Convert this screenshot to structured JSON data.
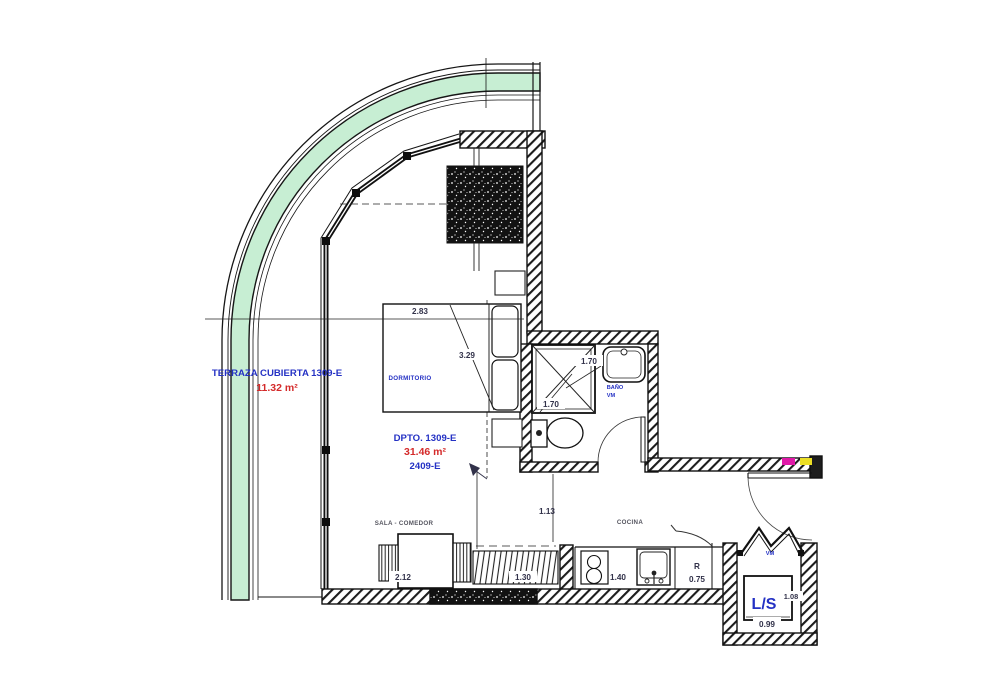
{
  "plan": {
    "terrace": {
      "label": "TERRAZA CUBIERTA 1309-E",
      "area": "11.32 m²"
    },
    "unit": {
      "label": "DPTO. 1309-E",
      "area": "31.46 m²",
      "code": "2409-E"
    },
    "rooms": {
      "bedroom": "DORMITORIO",
      "living": "SALA - COMEDOR",
      "kitchen": "COCINA",
      "bath": "BAÑO",
      "bath_vm": "VM",
      "laundry": "L/S",
      "laundry_vm": "VM",
      "fridge": "R"
    },
    "dims": {
      "bed_width": "2.83",
      "bed_diag": "3.29",
      "bath_a": "1.70",
      "bath_b": "1.70",
      "hall": "1.13",
      "table": "2.12",
      "rail": "1.30",
      "counter": "1.40",
      "fridge": "0.75",
      "ls_h": "1.08",
      "ls_w": "0.99"
    },
    "colors": {
      "blue": "#2431c4",
      "red": "#d42a2a",
      "dim": "#32324a",
      "gray": "#55555f",
      "green": "#c7eed3",
      "magenta": "#e018a8",
      "yellow": "#ecdf25"
    }
  }
}
